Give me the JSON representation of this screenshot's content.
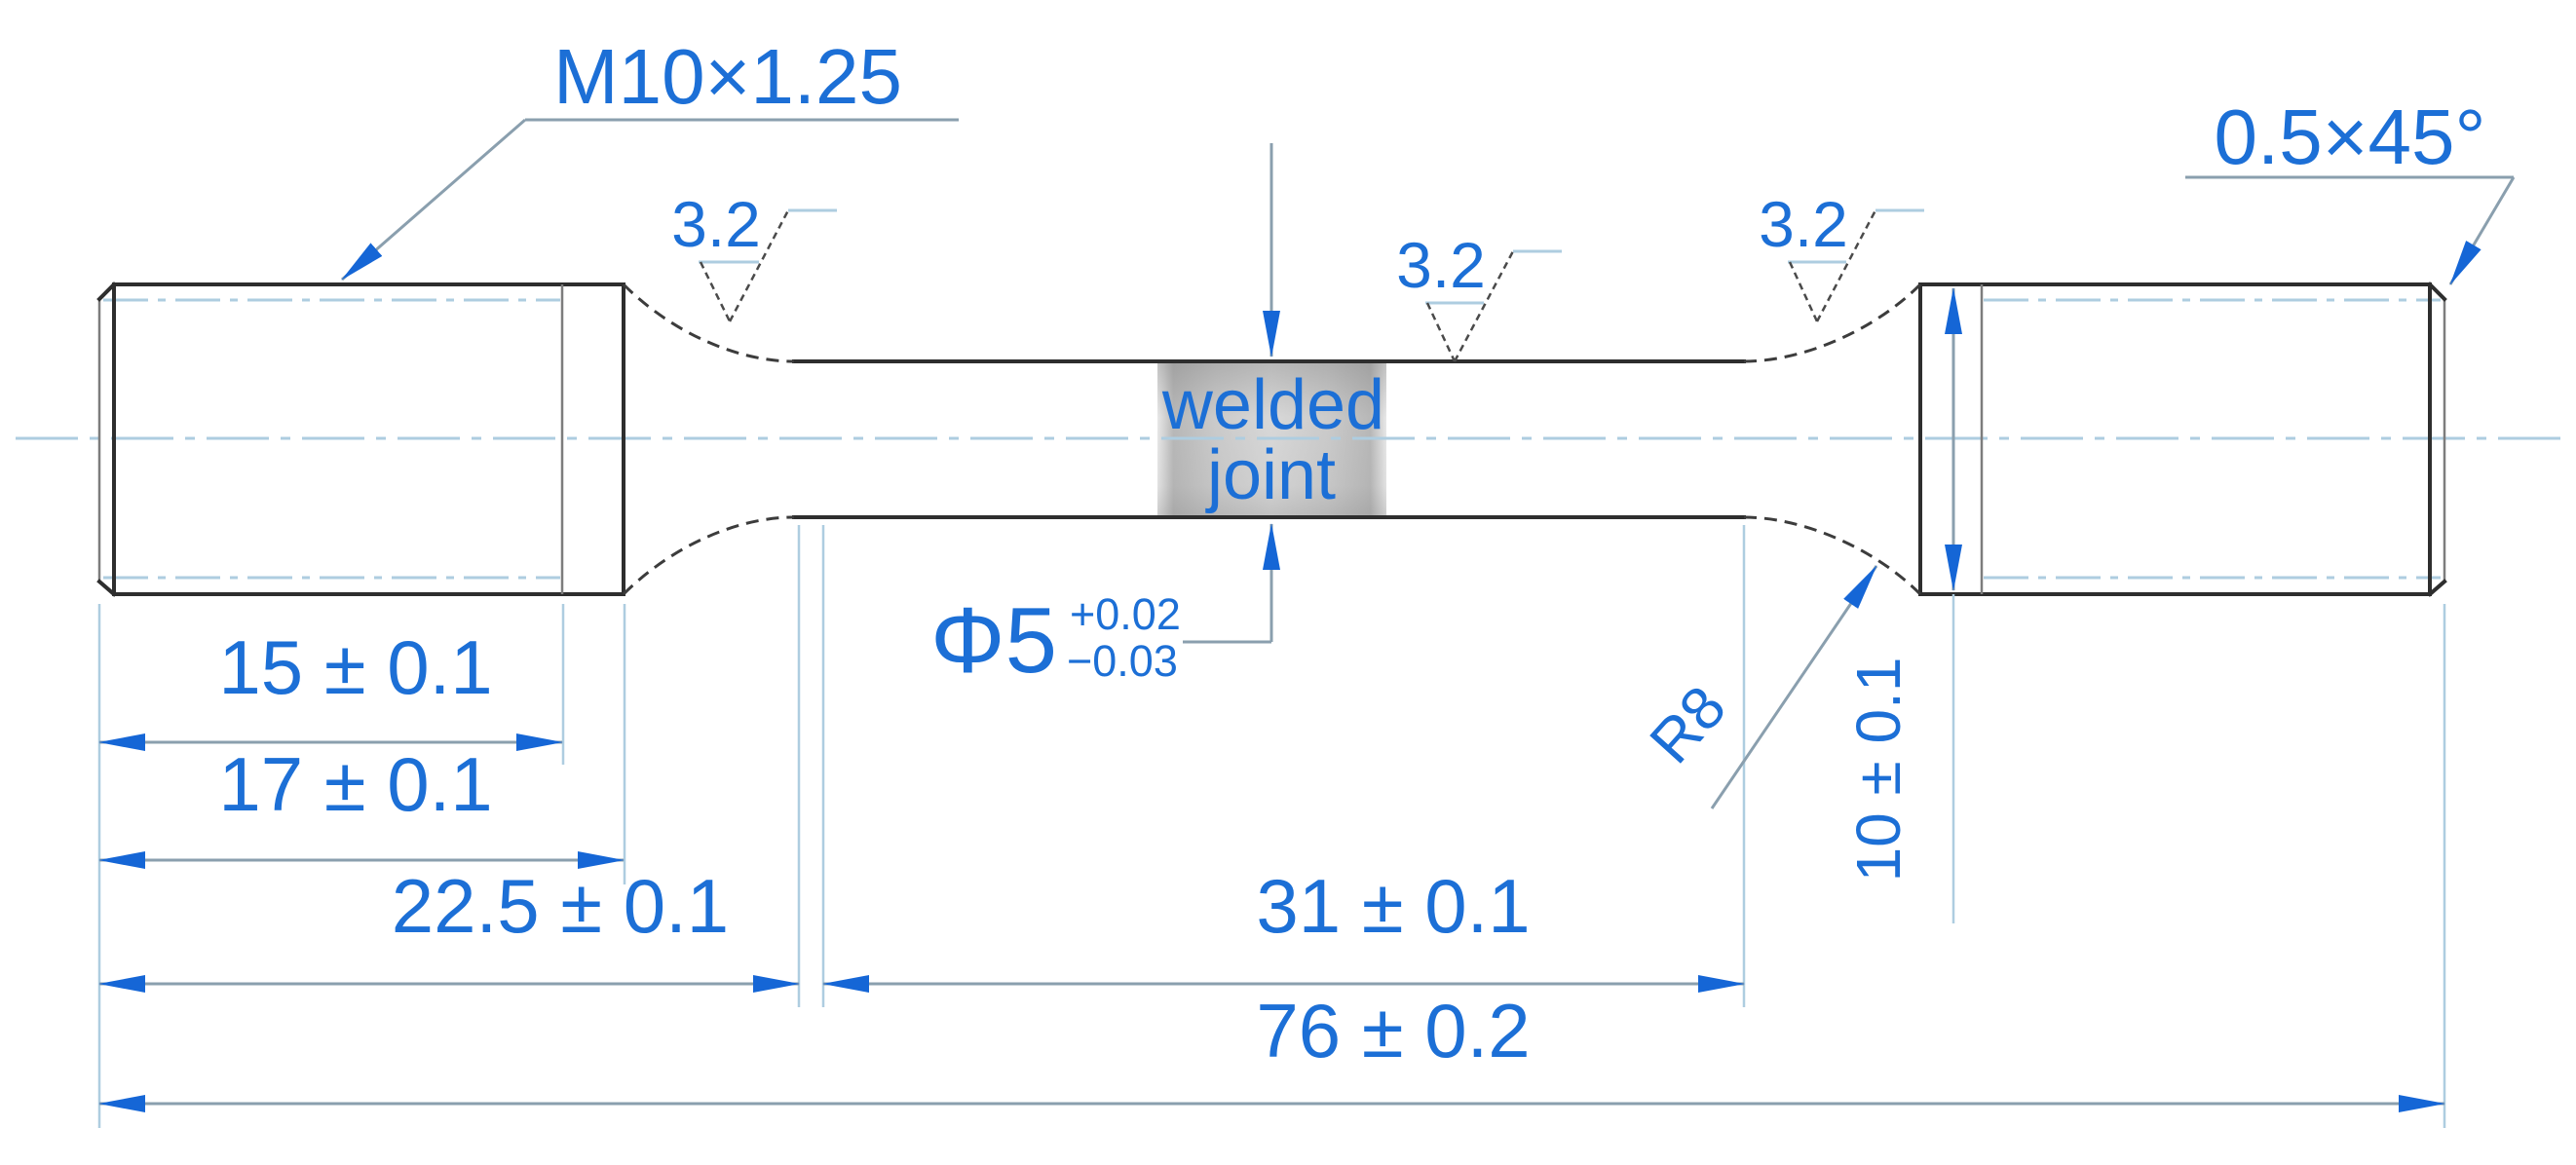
{
  "callouts": {
    "thread": "M10×1.25",
    "chamfer": "0.5×45°",
    "roughness_left": "3.2",
    "roughness_middle": "3.2",
    "roughness_right": "3.2",
    "weld_line1": "welded",
    "weld_line2": "joint",
    "diameter": "Φ5",
    "tol_plus": "+0.02",
    "tol_minus": "−0.03",
    "fillet_radius": "R8",
    "grip_diameter": "10 ± 0.1"
  },
  "dimensions": {
    "thread_length": "15 ± 0.1",
    "grip_length": "17 ± 0.1",
    "left_section": "22.5 ± 0.1",
    "gauge_length": "31 ± 0.1",
    "total_length": "76 ± 0.2"
  },
  "colors": {
    "annotation_blue": "#1c6fd6",
    "arrow_blue": "#1566d6",
    "line_light": "#aecde0",
    "dim_line": "#8a9fae",
    "outline": "#2e2e2e",
    "weld_gray": "#8c8c8c",
    "background": "#ffffff"
  }
}
